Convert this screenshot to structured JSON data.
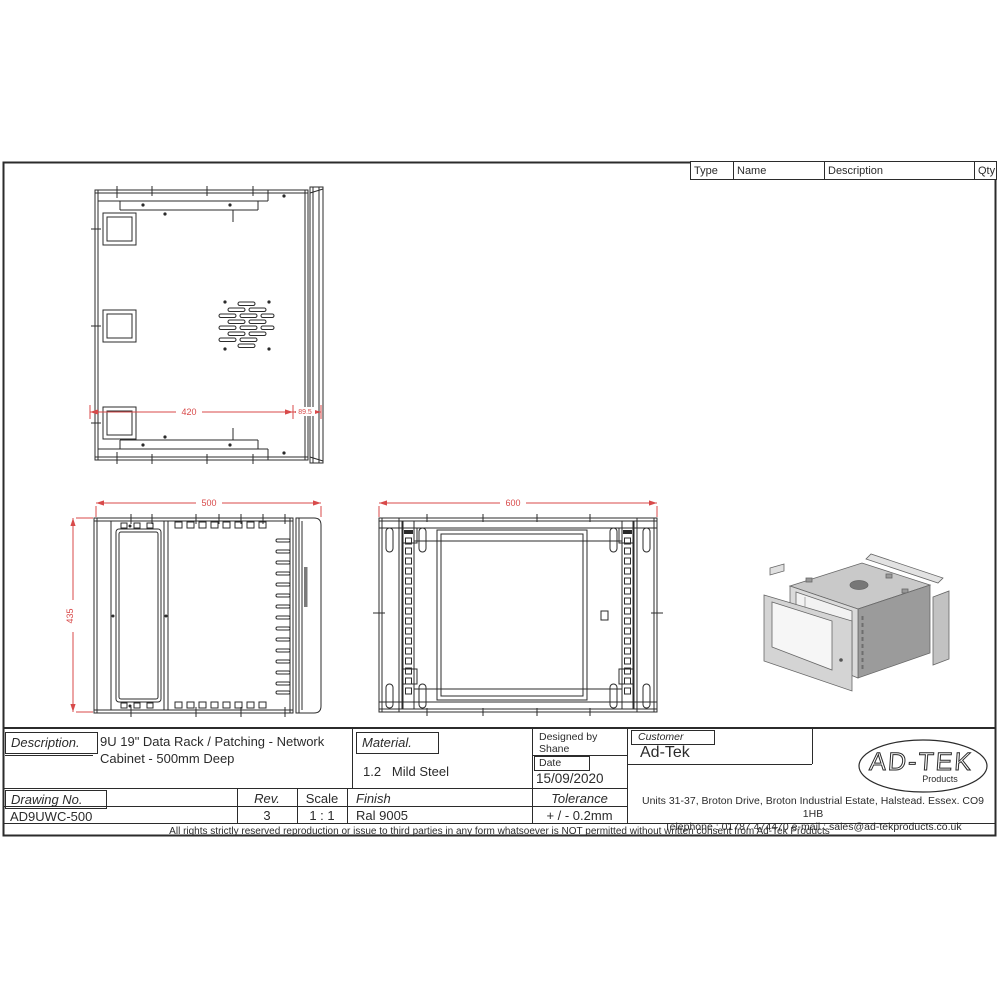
{
  "parts_table": {
    "headers": [
      "Type",
      "Name",
      "Description",
      "Qty"
    ]
  },
  "dimensions": {
    "top_view": {
      "width": "420",
      "side": "89.5"
    },
    "side_view": {
      "depth": "500",
      "height": "435"
    },
    "front_view": {
      "width": "600"
    }
  },
  "title_block": {
    "description_label": "Description.",
    "description_value": "9U 19\" Data Rack / Patching - Network Cabinet - 500mm Deep",
    "material_label": "Material.",
    "material_value": "1.2   Mild Steel",
    "designed_by_label": "Designed by",
    "designed_by_value": "Shane",
    "date_label": "Date",
    "date_value": "15/09/2020",
    "customer_label": "Customer",
    "customer_value": "Ad-Tek",
    "drawing_no_label": "Drawing No.",
    "drawing_no_value": "AD9UWC-500",
    "rev_label": "Rev.",
    "rev_value": "3",
    "scale_label": "Scale",
    "scale_value": "1 : 1",
    "finish_label": "Finish",
    "finish_value": "Ral 9005",
    "tolerance_label": "Tolerance",
    "tolerance_value": "+ / - 0.2mm",
    "address_line1": "Units 31-37, Broton Drive, Broton Industrial Estate, Halstead. Essex. CO9 1HB",
    "address_line2": "Telephone : 01787 474470  e-mail : sales@ad-tekproducts.co.uk",
    "disclaimer": "All rights strictly reserved reproduction or issue to third parties in any form whatsoever is NOT permitted without written consent from Ad-Tek Products"
  },
  "logo": {
    "name": "AD-TEK",
    "sub": "Products"
  },
  "colors": {
    "line": "#2b2b2b",
    "dimension": "#d84a4a",
    "shade_light": "#dadada",
    "shade_mid": "#c9c9c9",
    "shade_dark": "#9b9b9b"
  }
}
